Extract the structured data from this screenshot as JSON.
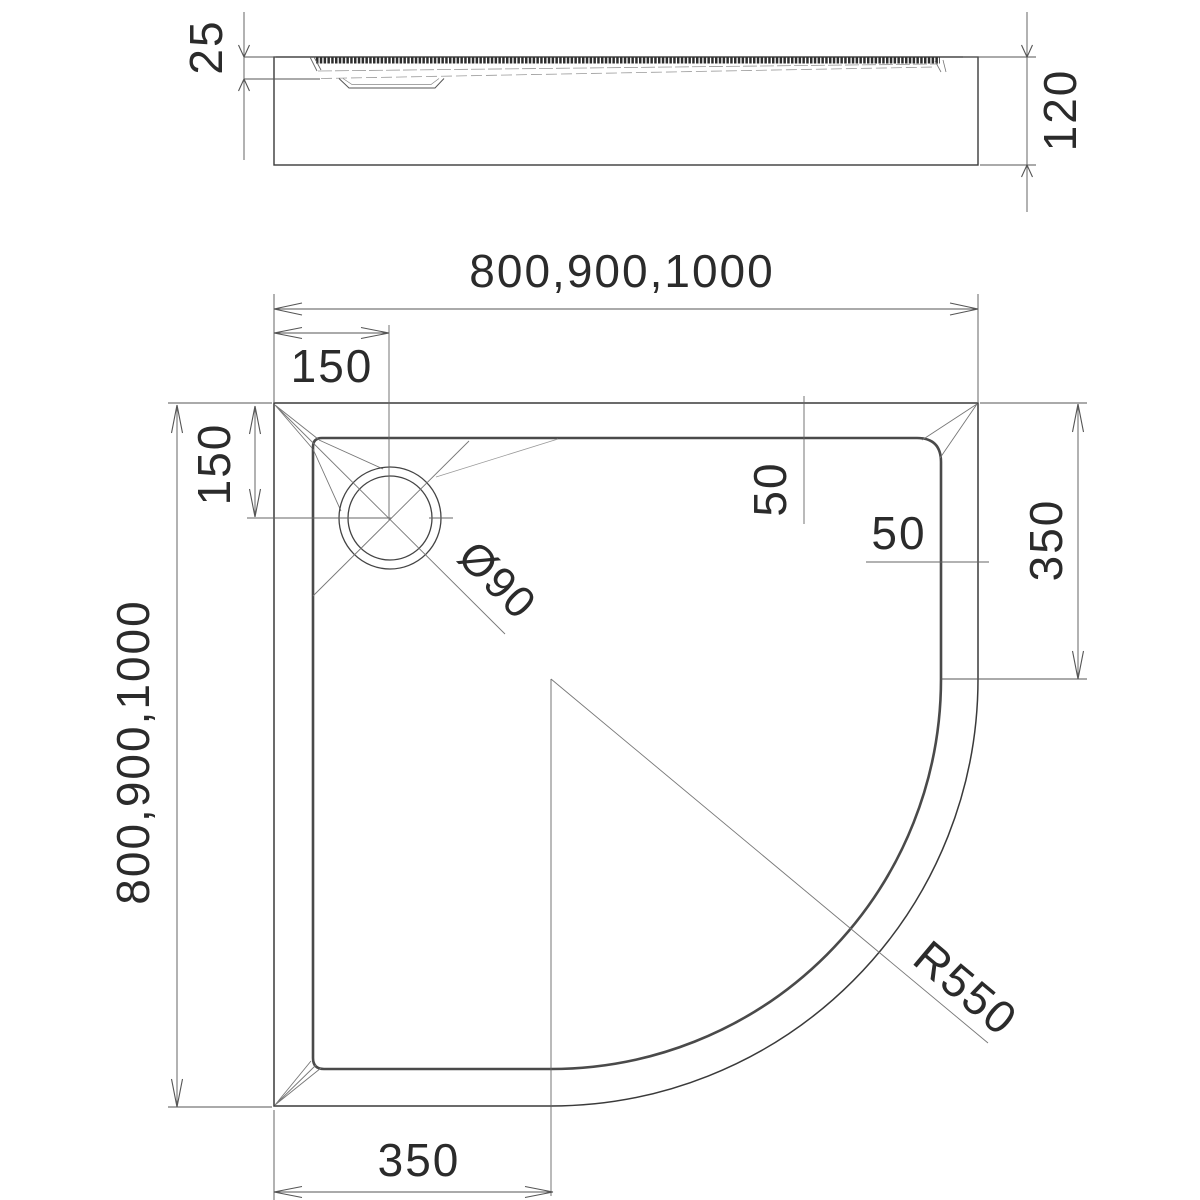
{
  "drawing": {
    "type": "technical-drawing-quadrant-shower-tray",
    "colors": {
      "background": "#ffffff",
      "outline": "#3a3a3a",
      "rim_line": "#4a4a4a",
      "thin_line": "#777777",
      "text": "#2b2b2b"
    },
    "side_view": {
      "tray_depth": "25",
      "tray_height": "120"
    },
    "plan_view": {
      "overall_width": "800,900,1000",
      "overall_depth": "800,900,1000",
      "drain_offset_horizontal": "150",
      "drain_offset_vertical": "150",
      "drain_diameter": "Ø90",
      "rim_width_top": "50",
      "rim_width_right": "50",
      "straight_edge_right": "350",
      "straight_edge_bottom": "350",
      "corner_radius": "R550"
    }
  }
}
